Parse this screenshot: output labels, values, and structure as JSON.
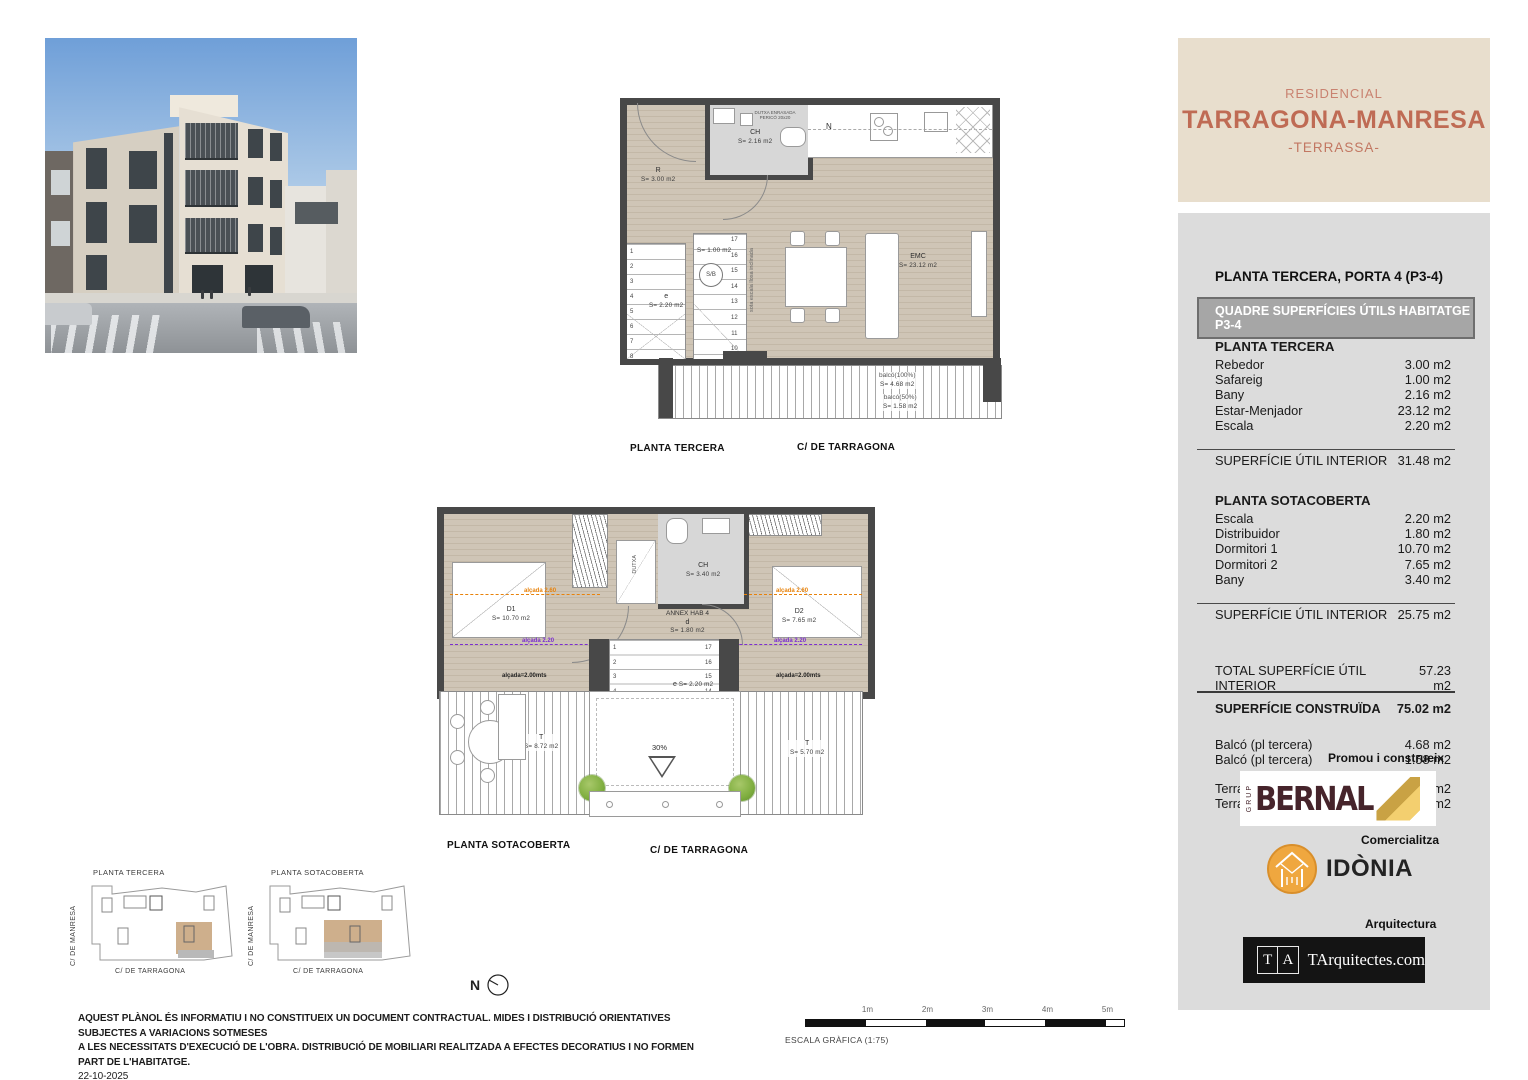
{
  "header": {
    "residencial": "RESIDENCIAL",
    "project": "TARRAGONA-MANRESA",
    "location": "-TERRASSA-"
  },
  "surfaces": {
    "unit_title": "PLANTA TERCERA, PORTA 4 (P3-4)",
    "quadre_title": "QUADRE SUPERFÍCIES ÚTILS HABITATGE P3-4",
    "planta_tercera_title": "PLANTA TERCERA",
    "planta_tercera_rows": [
      {
        "label": "Rebedor",
        "value": "3.00 m2"
      },
      {
        "label": "Safareig",
        "value": "1.00 m2"
      },
      {
        "label": "Bany",
        "value": "2.16 m2"
      },
      {
        "label": "Estar-Menjador",
        "value": "23.12 m2"
      },
      {
        "label": "Escala",
        "value": "2.20 m2"
      }
    ],
    "planta_tercera_subtotal": {
      "label": "SUPERFÍCIE ÚTIL INTERIOR",
      "value": "31.48 m2"
    },
    "planta_sotacoberta_title": "PLANTA SOTACOBERTA",
    "planta_sotacoberta_rows": [
      {
        "label": "Escala",
        "value": "2.20 m2"
      },
      {
        "label": "Distribuidor",
        "value": "1.80 m2"
      },
      {
        "label": "Dormitori 1",
        "value": "10.70 m2"
      },
      {
        "label": "Dormitori 2",
        "value": "7.65 m2"
      },
      {
        "label": "Bany",
        "value": "3.40 m2"
      }
    ],
    "planta_sotacoberta_subtotal": {
      "label": "SUPERFÍCIE ÚTIL INTERIOR",
      "value": "25.75 m2"
    },
    "total": {
      "label": "TOTAL SUPERFÍCIE ÚTIL INTERIOR",
      "value": "57.23 m2"
    },
    "construida": {
      "label": "SUPERFÍCIE CONSTRUÏDA",
      "value": "75.02 m2"
    },
    "balcons": [
      {
        "label": "Balcó (pl tercera)",
        "value": "4.68 m2"
      },
      {
        "label": "Balcó (pl tercera)",
        "value": "1.58 m2"
      }
    ],
    "terrasses": [
      {
        "label": "Terrassa (pl sotacoberta)",
        "value": "5.70 m2"
      },
      {
        "label": "Terrassa (pl sotacoberta)",
        "value": "8.72 m2"
      }
    ]
  },
  "branding": {
    "promou": "Promou i construeix",
    "grup": "GRUP",
    "bernal": "BERNAL",
    "comercialitza": "Comercialitza",
    "idonia": "IDÒNIA",
    "arquitectura": "Arquitectura",
    "ta_t": "T",
    "ta_a": "A",
    "ta_name": "TArquitectes.com"
  },
  "plan1": {
    "title": "PLANTA TERCERA",
    "street": "C/ DE TARRAGONA",
    "rebedor": "R",
    "rebedor_area": "S=  3.00  m2",
    "ch": "CH",
    "ch_area": "S=  2.16  m2",
    "dutxa_note": "DUTXA ENRASADA PERICÓ 20x20",
    "kitchen": "N",
    "emc": "EMC",
    "emc_area": "S=  23.12  m2",
    "escala_label": "e",
    "escala_area": "S=  2.20  m2",
    "sb": "S/B",
    "sb_area": "S=  1.00  m2",
    "sota_escala": "sota escala llosa inclinada",
    "balco1": "balcó(100%)",
    "balco1_area": "S=  4.68  m2",
    "balco2": "balcó(50%)",
    "balco2_area": "S=  1.58  m2",
    "stair_left": [
      "1",
      "2",
      "3",
      "4",
      "5",
      "6",
      "7",
      "8"
    ],
    "stair_right": [
      "17",
      "16",
      "15",
      "14",
      "13",
      "12",
      "11",
      "10"
    ]
  },
  "plan2": {
    "title": "PLANTA SOTACOBERTA",
    "street": "C/ DE TARRAGONA",
    "d1": "D1",
    "d1_area": "S=  10.70  m2",
    "d2": "D2",
    "d2_area": "S=  7.65  m2",
    "ch": "CH",
    "ch_area": "S=  3.40  m2",
    "annex": "ANNEX HAB 4",
    "annex_d": "d",
    "annex_area": "S=  1.80  m2",
    "dutxa": "DUTXA",
    "t1": "T",
    "t1_area": "S=  8.72  m2",
    "t2": "T",
    "t2_area": "S=  5.70  m2",
    "escala_label": "e",
    "escala_area": "S=  2.20  m2",
    "slope": "30%",
    "alcada260": "alçada 2.60",
    "alcada220": "alçada 2.20",
    "alcada200": "alçada=2.00mts",
    "stair_left": [
      "1",
      "2",
      "3",
      "4",
      "5"
    ],
    "stair_right": [
      "17",
      "16",
      "15",
      "14",
      "13",
      "12",
      "11",
      "10"
    ]
  },
  "keyplans": {
    "left_title": "PLANTA TERCERA",
    "right_title": "PLANTA SOTACOBERTA",
    "street_v": "C/ DE MANRESA",
    "street_h": "C/ DE TARRAGONA"
  },
  "compass": {
    "n": "N"
  },
  "scale": {
    "ticks": [
      "1m",
      "2m",
      "3m",
      "4m",
      "5m"
    ],
    "label": "ESCALA GRÀFICA (1:75)"
  },
  "disclaimer": {
    "line1": "AQUEST PLÀNOL ÉS INFORMATIU I NO CONSTITUEIX UN DOCUMENT CONTRACTUAL. MIDES I DISTRIBUCIÓ ORIENTATIVES SUBJECTES A VARIACIONS SOTMESES",
    "line2": "A LES NECESSITATS D'EXECUCIÓ DE L'OBRA. DISTRIBUCIÓ DE MOBILIARI REALITZADA A EFECTES DECORATIUS I NO FORMEN PART DE L'HABITATGE.",
    "date": "22-10-2025"
  },
  "colors": {
    "accent": "#bf6b54",
    "beige": "#e8decd",
    "panel_gray": "#dcdcdc",
    "wall": "#484848",
    "wood": "#cdc3b6",
    "orange": "#e8820a",
    "purple": "#7b2fd0",
    "idonia_orange": "#efa73f",
    "bernal_maroon": "#46242b"
  }
}
